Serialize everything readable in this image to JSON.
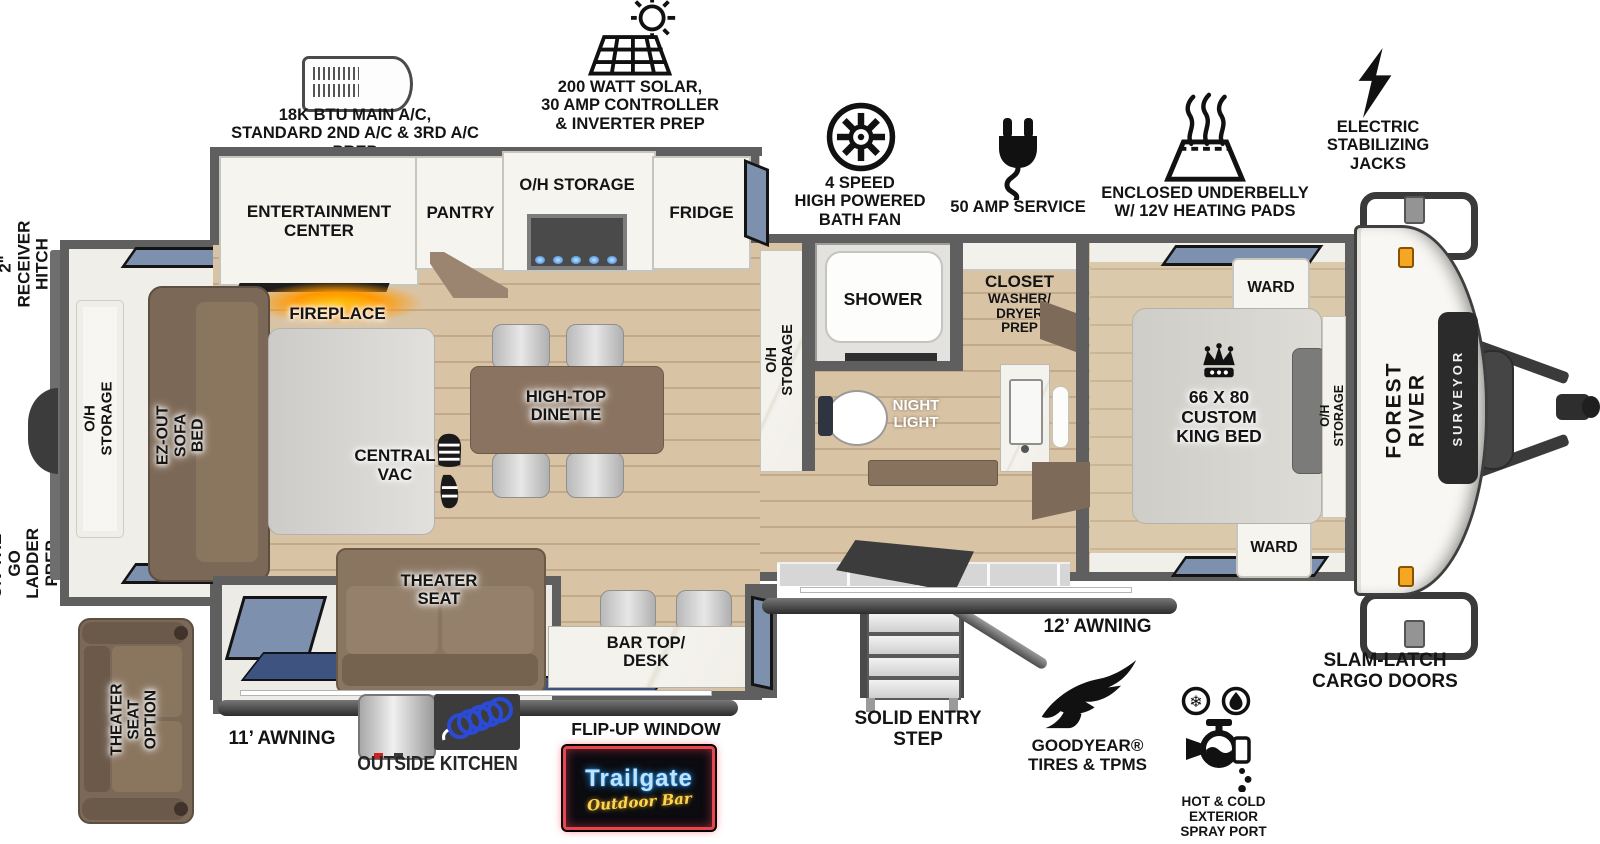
{
  "feature_callouts": {
    "main_ac": "18K BTU MAIN A/C,\nSTANDARD 2ND A/C & 3RD A/C PREP",
    "solar": "200 WATT SOLAR,\n30 AMP CONTROLLER\n& INVERTER PREP",
    "bath_fan": "4 SPEED\nHIGH POWERED\nBATH FAN",
    "amp_service": "50 AMP SERVICE",
    "underbelly": "ENCLOSED UNDERBELLY\nW/ 12V HEATING PADS",
    "stabilizing_jacks": "ELECTRIC\nSTABILIZING\nJACKS",
    "receiver_hitch": "2\" RECEIVER\nHITCH",
    "ladder_prep": "ON-THE-GO\nLADDER PREP",
    "awning_11": "11’ AWNING",
    "awning_12": "12’ AWNING",
    "outside_kitchen": "OUTSIDE KITCHEN",
    "flip_up_window": "FLIP-UP WINDOW",
    "solid_entry_step": "SOLID ENTRY\nSTEP",
    "goodyear_tires": "GOODYEAR®\nTIRES & TPMS",
    "spray_port": "HOT & COLD EXTERIOR\nSPRAY PORT",
    "slam_latch": "SLAM-LATCH\nCARGO DOORS",
    "theater_seat_option": "THEATER SEAT\nOPTION"
  },
  "interior_labels": {
    "rear_oh_storage": "O/H STORAGE",
    "sofa_bed": "EZ-OUT\nSOFA BED",
    "entertainment_center": "ENTERTAINMENT\nCENTER",
    "fireplace": "FIREPLACE",
    "pantry": "PANTRY",
    "kitchen_oh_storage": "O/H STORAGE",
    "fridge": "FRIDGE",
    "high_top_dinette": "HIGH-TOP\nDINETTE",
    "central_vac": "CENTRAL\nVAC",
    "theater_seat": "THEATER\nSEAT",
    "bar_top_desk": "BAR TOP/\nDESK",
    "bath_oh_storage": "O/H STORAGE",
    "shower": "SHOWER",
    "night_light": "NIGHT\nLIGHT",
    "closet": "CLOSET",
    "washer_dryer_prep": "WASHER/\nDRYER\nPREP",
    "ward_rear": "WARD",
    "ward_front": "WARD",
    "king_bed": "66 X 80\nCUSTOM\nKING BED",
    "bed_oh_storage": "O/H STORAGE"
  },
  "branding": {
    "make": "FOREST RIVER",
    "model": "SURVEYOR",
    "bar_sign_title": "Trailgate",
    "bar_sign_subtitle": "Outdoor Bar"
  },
  "colors": {
    "wall": "#5f5f5f",
    "floor_wood": "#d9c3a5",
    "cabinet_white": "#f5f4ef",
    "furniture_brown": "#7c6856",
    "window_blue": "#7d90ad",
    "mat_navy": "#3f5380",
    "fireplace_glow": "#ff9900",
    "marker_light_orange": "#f5a623",
    "neon_red": "#e8454f",
    "neon_blue": "#7ec8ff",
    "neon_gold": "#ffd34d"
  }
}
